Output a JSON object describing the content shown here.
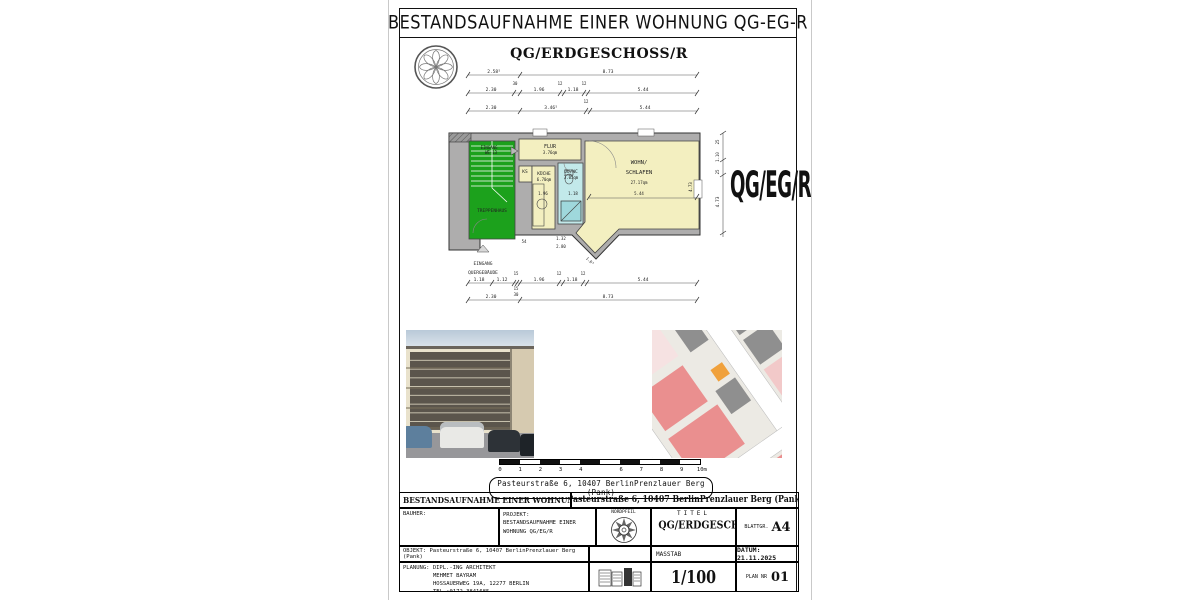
{
  "sheet": {
    "title": "BESTANDSAUFNAHME EINER WOHNUNG QG-EG-R",
    "subtitle": "QG/ERDGESCHOSS/R",
    "side_label": "QG/EG/R"
  },
  "plan": {
    "rooms": {
      "treppenhaus": "TREPPENHAUS",
      "eingang_we_1": "EINGANG",
      "eingang_we_2": "WE-13",
      "flur_name": "FLUR",
      "flur_area": "3.76qm",
      "ks": "KS",
      "kueche_name": "KÜCHE",
      "kueche_area": "6.70qm",
      "duwc_name": "DU/WC",
      "duwc_area": "3.05qm",
      "wohn_name_1": "WOHN/",
      "wohn_name_2": "SCHLAFEN",
      "wohn_area": "27.17qm",
      "eingang_quer_1": "EINGANG",
      "eingang_quer_2": "QUERGEBÄUDE"
    },
    "dims": {
      "t1": [
        "2.58⁵",
        "8.73"
      ],
      "t2": [
        "2.30",
        "30",
        "1.96",
        "12",
        "1.18",
        "12",
        "5.44"
      ],
      "t3": [
        "2.30",
        "3.46⁵",
        "12",
        "5.44"
      ],
      "b1": [
        "1.18",
        "1.12",
        "15",
        "1.96",
        "12",
        "1.18",
        "12",
        "5.44"
      ],
      "b1s": [
        "15",
        "30"
      ],
      "b2": [
        "2.30",
        "8.73"
      ],
      "right": [
        "25",
        "1.10",
        "25"
      ],
      "right_main": "4.73",
      "inner": {
        "kueche_w": "1.96",
        "wc_w": "1.18",
        "wohn_w": "5.44",
        "wohn_h": "4.73",
        "b_54": "54",
        "b_132": "1.32",
        "b_280": "2.80",
        "diag": "1.0⁵"
      }
    }
  },
  "scalebar": {
    "ticks": [
      "0",
      "1",
      "2",
      "3",
      "4",
      "",
      "6",
      "7",
      "8",
      "9",
      "10m"
    ]
  },
  "address": "Pasteurstraße 6, 10407 BerlinPrenzlauer Berg (Pank)",
  "titleblock": {
    "header_left": "BESTANDSAUFNAHME EINER WOHNUNG QG/EG/R",
    "header_right": "Pasteurstraße 6, 10407 BerlinPrenzlauer Berg (Pank)",
    "bauherr_label": "BAUHER:",
    "projekt_label": "PROJEKT:",
    "projekt_line1": "BESTANDSAUFNAHME EINER",
    "projekt_line2": "WOHNUNG QG/EG/R",
    "nordpfeil_label": "NORDPFEIL",
    "titel_label": "TITEL",
    "titel_value": "QG/ERDGESCHOSS/R",
    "blattgr_label": "BLATTGR.",
    "blattgr_value": "A4",
    "objekt_label": "OBJEKT:",
    "objekt_value": "Pasteurstraße 6, 10407 BerlinPrenzlauer Berg (Pank)",
    "masstab_label": "MASSTAB",
    "masstab_value": "1/100",
    "datum": "DATUM: 21.11.2025",
    "planung_label": "PLANUNG:",
    "planung_line1": "DIPL.-ING ARCHITEKT",
    "planung_line2": "MEHMET BAYRAM",
    "planung_line3": "HOSSAUERWEG 19A, 12277 BERLIN",
    "planung_line4": "TEL :0172-3841685",
    "plannr_label": "PLAN NR",
    "plannr_value": "01"
  }
}
